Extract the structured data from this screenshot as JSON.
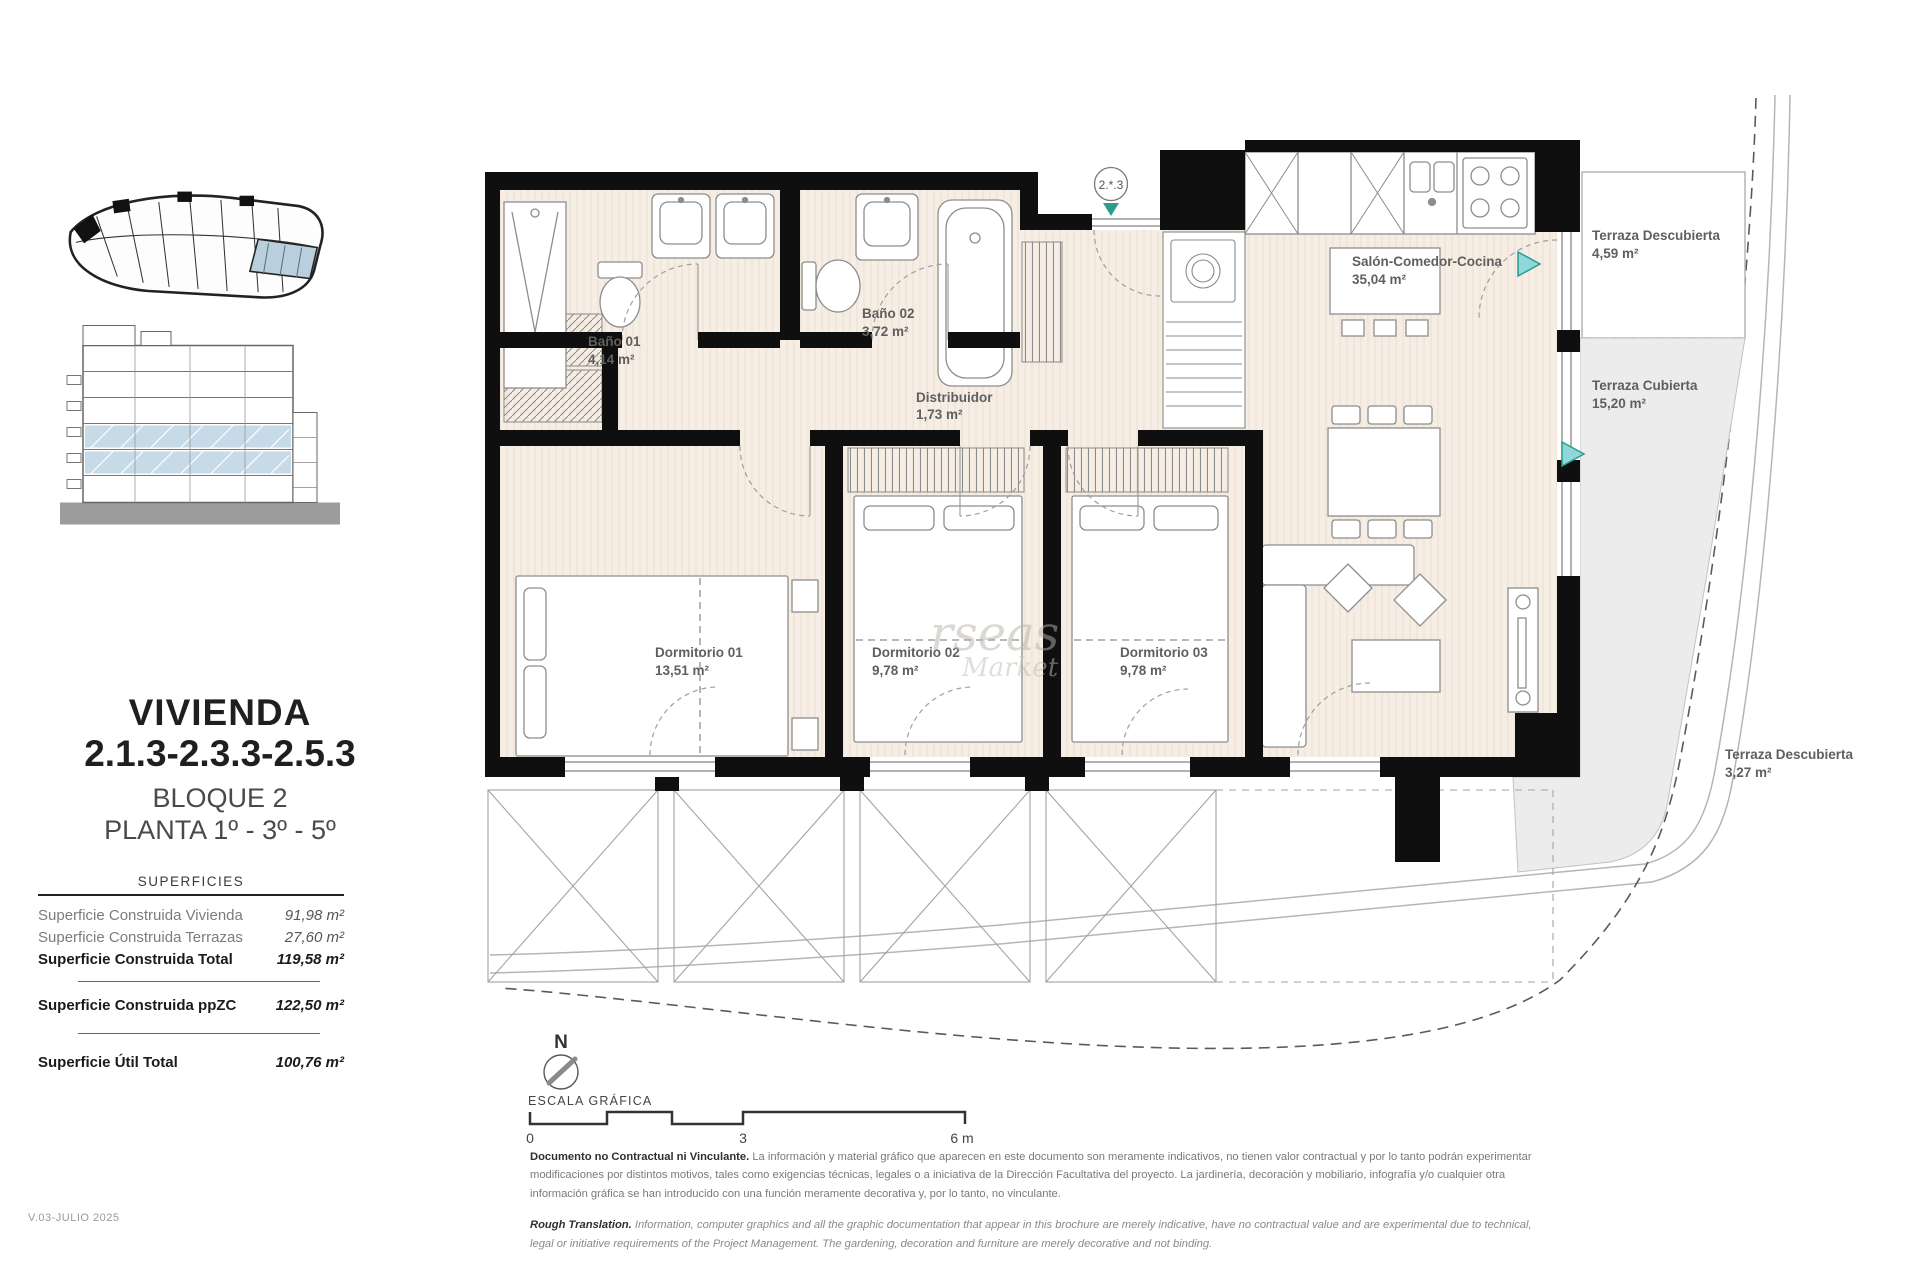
{
  "colors": {
    "marker_teal": "#2a9d8f",
    "triangle_fill": "#8fd7da",
    "highlight_blue": "#b9cfdd",
    "wall_black": "#0f0f0f",
    "floor_beige": "#f6ede4",
    "terrace_gray": "#ececec"
  },
  "sidebar": {
    "title_line1": "VIVIENDA",
    "title_line2": "2.1.3-2.3.3-2.5.3",
    "subtitle_line1": "BLOQUE 2",
    "subtitle_line2": "PLANTA 1º - 3º - 5º",
    "surfaces": {
      "header": "SUPERFICIES",
      "rows": [
        {
          "label": "Superficie Construida Vivienda",
          "value": "91,98 m²"
        },
        {
          "label": "Superficie Construida Terrazas",
          "value": "27,60 m²"
        },
        {
          "label": "Superficie Construida Total",
          "value": "119,58 m²"
        },
        {
          "label": "Superficie Construida ppZC",
          "value": "122,50 m²"
        },
        {
          "label": "Superficie Útil Total",
          "value": "100,76 m²"
        }
      ]
    }
  },
  "plan": {
    "unit_marker": "2.*.3",
    "rooms": {
      "bano01": {
        "name": "Baño 01",
        "area": "4,14 m²"
      },
      "bano02": {
        "name": "Baño 02",
        "area": "3,72 m²"
      },
      "distrib": {
        "name": "Distribuidor",
        "area": "1,73 m²"
      },
      "salon": {
        "name": "Salón-Comedor-Cocina",
        "area": "35,04 m²"
      },
      "dorm1": {
        "name": "Dormitorio 01",
        "area": "13,51 m²"
      },
      "dorm2": {
        "name": "Dormitorio 02",
        "area": "9,78 m²"
      },
      "dorm3": {
        "name": "Dormitorio 03",
        "area": "9,78 m²"
      },
      "terr1": {
        "name": "Terraza Descubierta",
        "area": "4,59 m²"
      },
      "terr2": {
        "name": "Terraza Cubierta",
        "area": "15,20 m²"
      },
      "terr3": {
        "name": "Terraza Descubierta",
        "area": "3,27 m²"
      }
    },
    "watermark": {
      "line1": "rseas",
      "line2": "Market"
    }
  },
  "footer": {
    "north_label": "N",
    "scale_title": "ESCALA GRÁFICA",
    "scale_ticks": {
      "start": "0",
      "mid": "3",
      "end": "6 m"
    },
    "disclaimer_es_lead": "Documento no Contractual ni Vinculante.",
    "disclaimer_es_body": "La información y material gráfico que aparecen en este documento son meramente indicativos, no tienen valor contractual y por lo tanto podrán experimentar modificaciones por distintos motivos, tales como exigencias técnicas, legales o a iniciativa de la Dirección Facultativa del proyecto. La jardinería, decoración y mobiliario, infografía y/o cualquier otra información gráfica se han introducido con una función meramente decorativa y, por lo tanto, no vinculante.",
    "disclaimer_en_lead": "Rough Translation.",
    "disclaimer_en_body": "Information, computer graphics and all the graphic documentation that appear in this brochure are merely indicative, have no contractual value and are experimental due to technical, legal or initiative requirements of the Project Management. The gardening, decoration and furniture are merely decorative and not binding.",
    "version": "V.03-JULIO 2025"
  }
}
